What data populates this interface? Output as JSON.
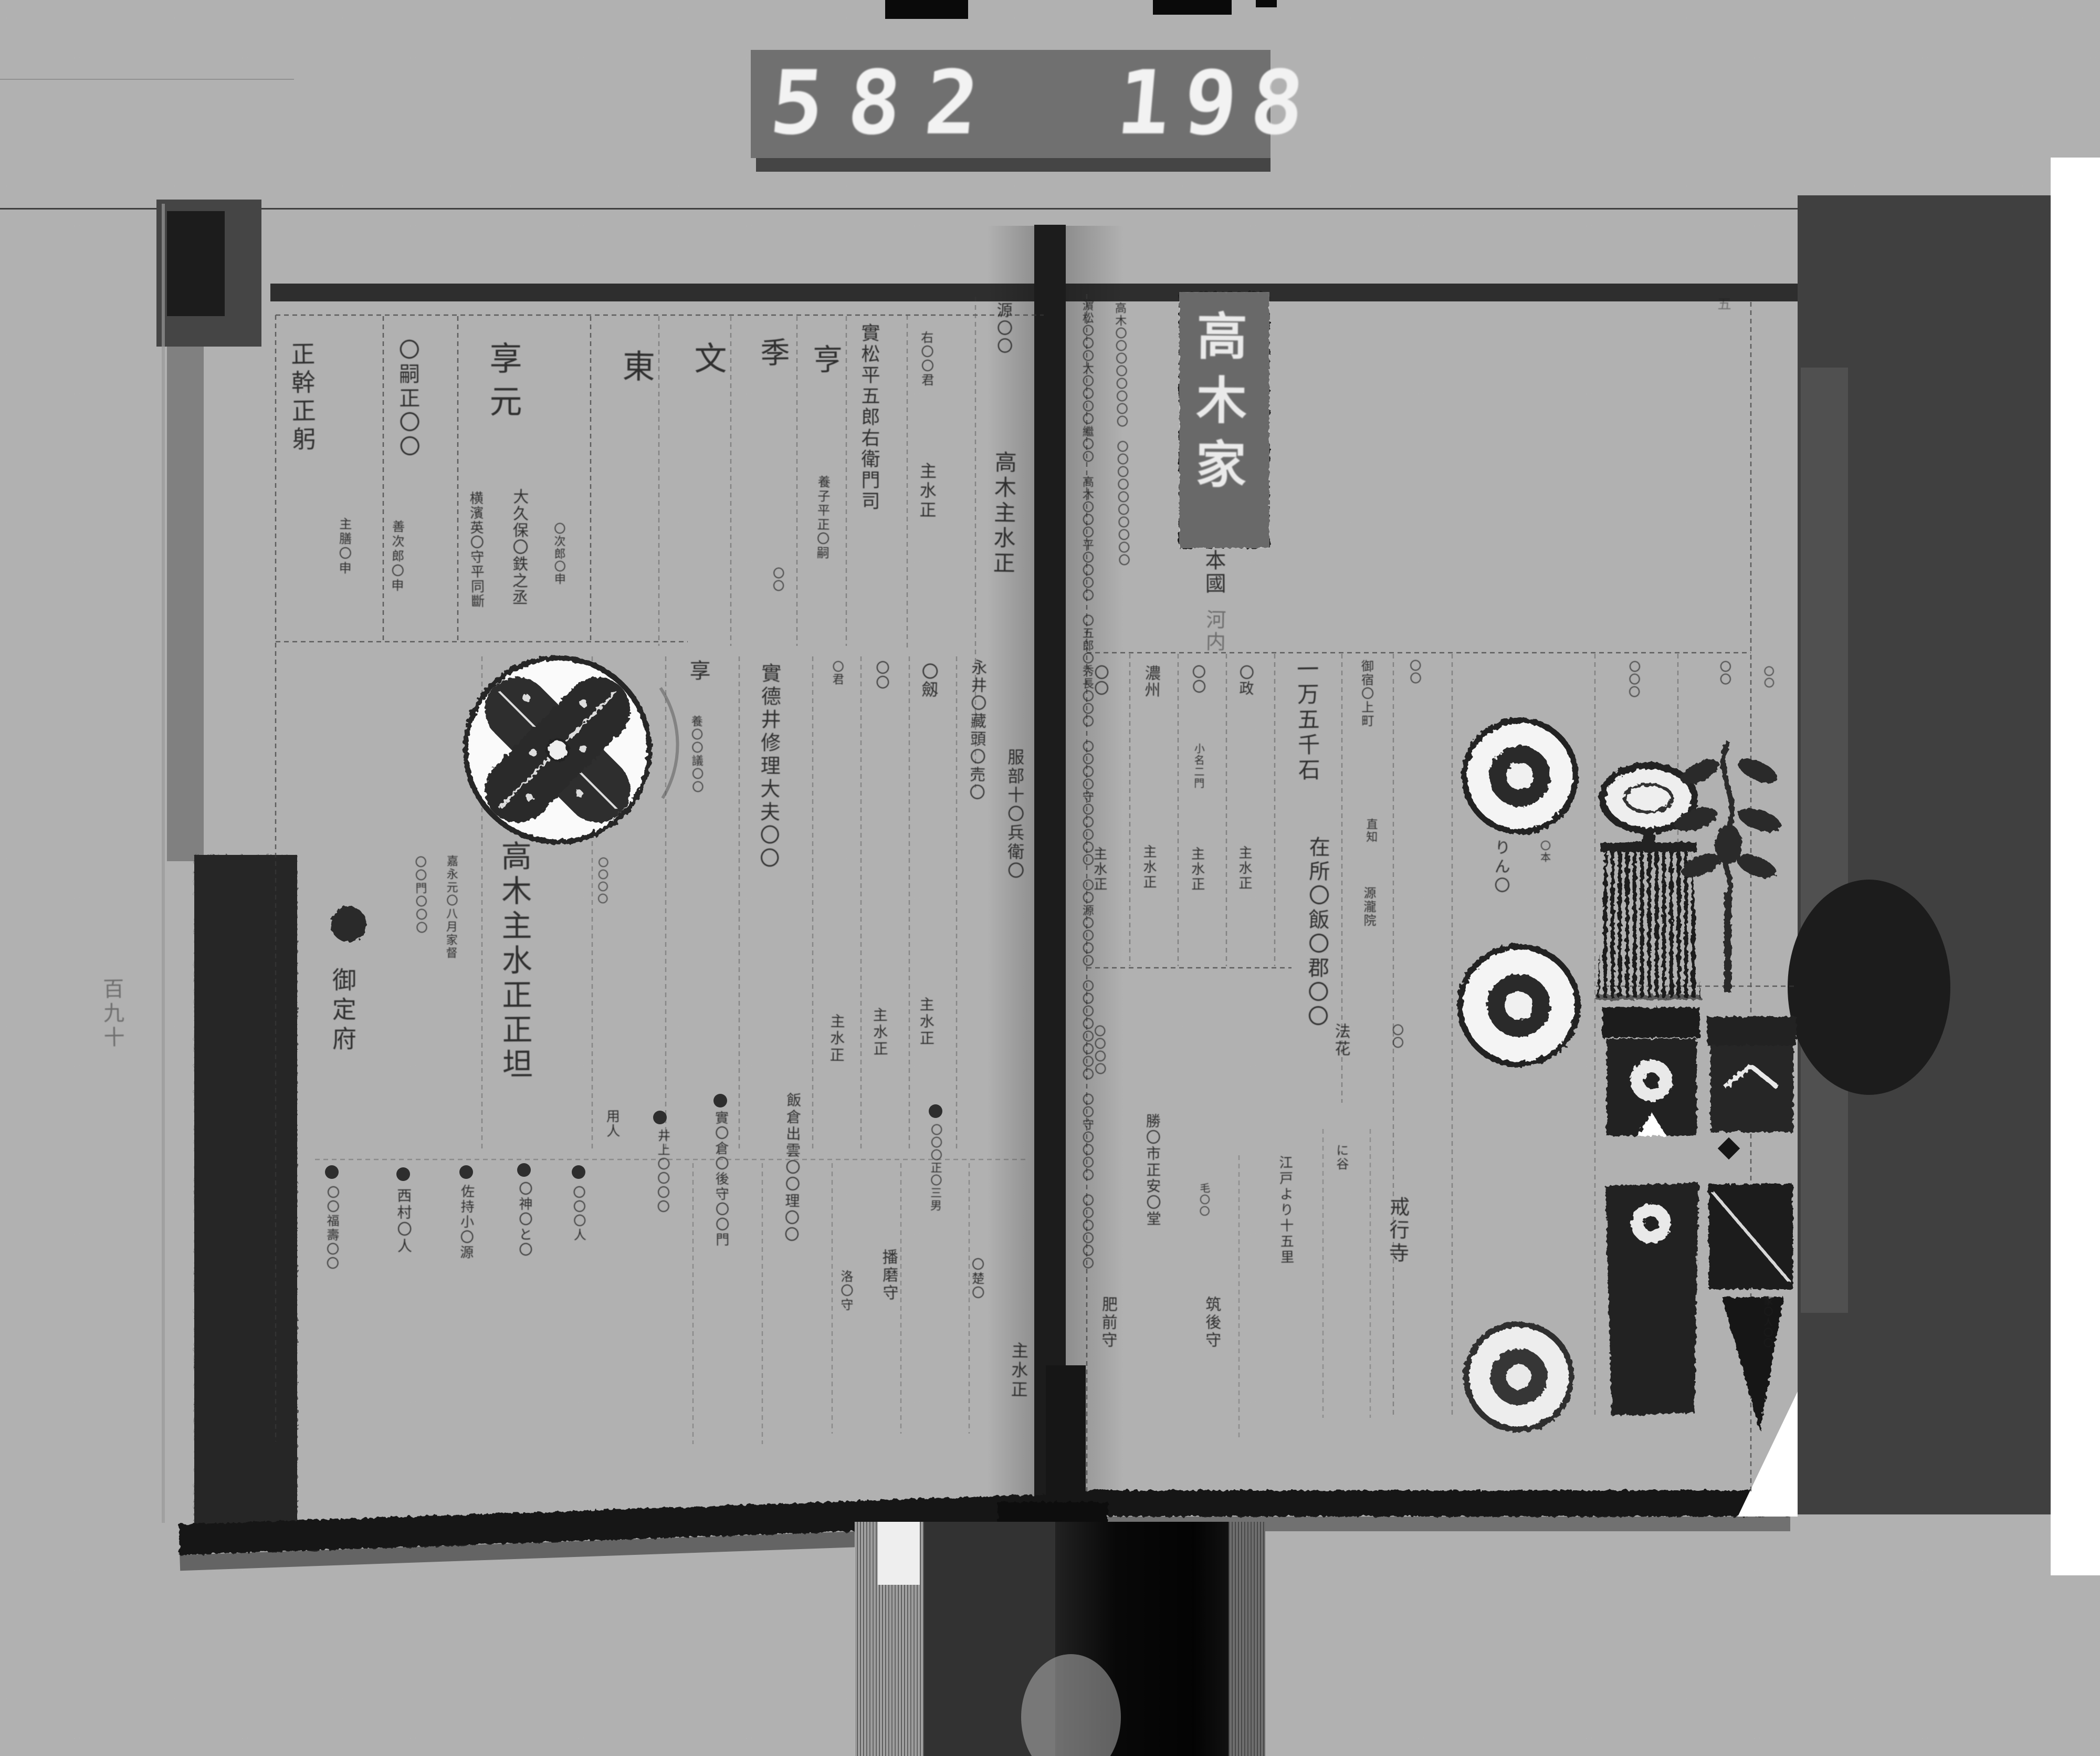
{
  "counter": {
    "left": "582",
    "right": "198"
  },
  "folio": "五",
  "margin_note": "百九十",
  "lp": {
    "top": {
      "k1": "正幹正躬",
      "k1s": "主膳〇申",
      "k2": "〇嗣正〇〇",
      "k2s": "善次郎〇申",
      "k3": "享元",
      "k3a": "横濱英〇守平同斷",
      "k3b": "大久保〇鉄之丞",
      "k3c": "〇次郎〇申",
      "k4": "東",
      "k5": "文",
      "k6": "季",
      "k6s": "〇〇",
      "k7": "亨",
      "k7s": "養子平正〇嗣",
      "k8": "實松平五郎右衛門司",
      "k9": "右〇〇君",
      "k9s": "主水正",
      "k10": "源〇〇",
      "k10s": "高木主水正"
    },
    "mid": {
      "teifu": "御定府",
      "n1": "〇〇門〇〇〇",
      "n2": "嘉永元〇八月家督",
      "name": "高木主水正正坦",
      "n3": "〇〇〇〇",
      "kyo": "享",
      "kyos": "養〇〇議〇〇",
      "nagai": "實德井修理大夫〇〇",
      "h1": "〇君",
      "h1s": "主水正",
      "h2": "〇〇",
      "h2s": "主水正",
      "h3": "〇劔",
      "h3s": "主水正",
      "n4": "永井〇藏頭〇売〇",
      "n5": "服部十〇兵衛〇"
    },
    "bot": {
      "yonin": "用人",
      "m1": "〇〇福壽〇〇",
      "m2": "西村〇人",
      "m3": "佐持小〇源",
      "m4": "〇神〇と〇",
      "m5": "〇〇〇人",
      "m6": "井上〇〇〇〇",
      "m7": "實〇倉〇後守〇〇門",
      "m8": "飯倉出雲〇〇理〇〇",
      "m9": "洛〇守",
      "m10": "播磨守",
      "m11": "〇〇〇正〇三男",
      "m12": "〇楚〇",
      "m13": "主水正"
    }
  },
  "rp": {
    "note1": "濵松〇〇〇大〇〇〇〇繼〇〇　高木〇〇〇平〇〇〇〇　〇五郎〇秀長〇〇〇　〇〇〇〇守〇〇〇〇〇　〇〇源〇〇〇〇　〇〇〇〇〇〇〇〇　〇〇守〇〇〇〇　〇〇〇〇〇〇",
    "note2": "高木〇〇〇〇〇〇〇〇　〇〇〇〇〇〇〇〇〇〇",
    "title": "高木家",
    "honkoku": "本國",
    "province": "河内",
    "mid": {
      "c1": "〇〇",
      "c1s": "主水正",
      "c2": "濃州",
      "c2s": "主水正",
      "c3": "〇〇",
      "c3n": "小名二門",
      "c3s": "主水正",
      "c4": "〇政",
      "c4s": "主水正",
      "koku": "一万五千石",
      "zaisho": "在所〇飯〇郡〇〇",
      "yado": "御宿〇上町",
      "naoshi": "直知",
      "genryuin": "源瀧院",
      "f1": "〇〇",
      "kana": "りん〇",
      "hon": "〇本",
      "t1": "〇〇〇",
      "t2": "〇〇"
    },
    "bot": {
      "b1": "〇〇〇〇",
      "b2": "肥前守",
      "b3": "勝〇市正安〇堂",
      "b4": "毛〇〇",
      "b5": "筑後守",
      "edo": "江戸より十五里",
      "hokke": "法花",
      "niya": "に谷",
      "kaigyoji": "戒行寺",
      "b6": "〇〇",
      "r1": "〇〇",
      "r2": "家〇人〇〇"
    }
  }
}
